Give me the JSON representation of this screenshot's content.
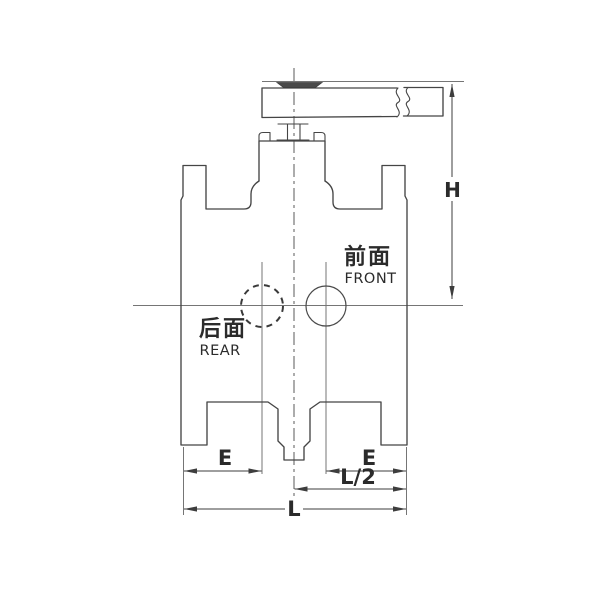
{
  "labels": {
    "front_cn": "前面",
    "front_en": "FRONT",
    "rear_cn": "后面",
    "rear_en": "REAR"
  },
  "dimensions": {
    "height": "H",
    "e_left": "E",
    "e_right": "E",
    "half_length": "L/2",
    "total_length": "L"
  },
  "colors": {
    "background": "#ffffff",
    "line": "#454545",
    "thin_line": "#757575",
    "text": "#2b2b2b"
  }
}
